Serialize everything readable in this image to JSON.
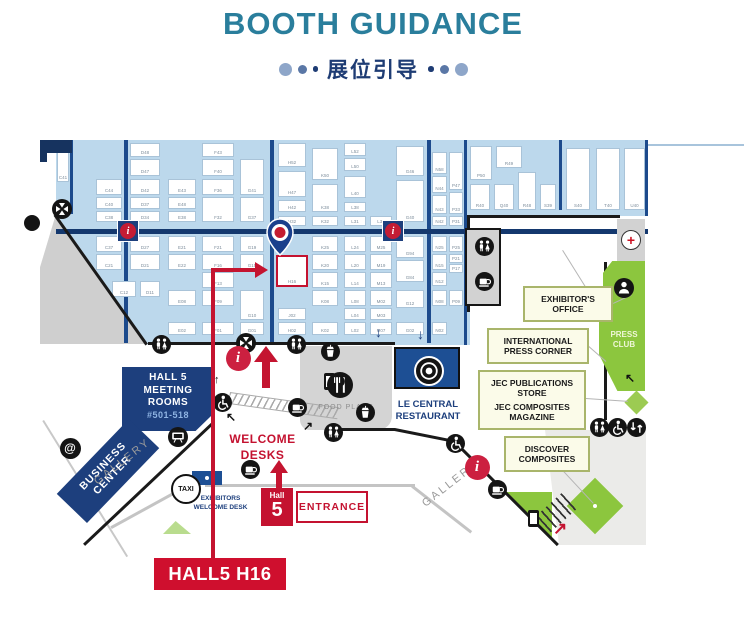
{
  "header": {
    "title": "BOOTH GUIDANCE",
    "subtitle": "展位引导"
  },
  "colors": {
    "accent_red": "#c41230",
    "navy": "#1d3f7d",
    "hall_blue": "#bcd8ec",
    "teal_title": "#2a7e9c",
    "green": "#8cc63e"
  },
  "map": {
    "labels": {
      "meeting": {
        "line1": "HALL 5",
        "line2": "MEETING",
        "line3": "ROOMS",
        "line4": "#501-518"
      },
      "business": {
        "line1": "BUSINESS",
        "line2": "CENTER"
      },
      "gallery_left": "GALLERY",
      "gallery_right": "GALLERY",
      "taxi": "TAXI",
      "exhibitors_desk": {
        "line1": "EXHIBITORS",
        "line2": "WELCOME DESK"
      },
      "welcome_desks": {
        "line1": "WELCOME",
        "line2": "DESKS"
      },
      "entrance": {
        "hall": "Hall",
        "number": "5",
        "label": "ENTRANCE"
      },
      "food_place": "FOOD PLACE",
      "le_central": {
        "line1": "LE CENTRAL",
        "line2": "RESTAURANT"
      },
      "exhibitors_office": {
        "line1": "EXHIBITOR'S",
        "line2": "OFFICE"
      },
      "intl_press": {
        "line1": "INTERNATIONAL",
        "line2": "PRESS CORNER"
      },
      "jec_store": {
        "line1": "JEC PUBLICATIONS",
        "line2": "STORE"
      },
      "jec_magazine": {
        "line1": "JEC COMPOSITES",
        "line2": "MAGAZINE"
      },
      "discover": {
        "line1": "DISCOVER",
        "line2": "COMPOSITES"
      },
      "press_club": {
        "line1": "PRESS",
        "line2": "CLUB"
      },
      "target": "HALL5 H16",
      "target_booth": "H16"
    },
    "booths": [
      [
        57,
        152,
        12,
        30,
        "C41"
      ],
      [
        96,
        179,
        26,
        16,
        "C44"
      ],
      [
        96,
        197,
        26,
        12,
        "C40"
      ],
      [
        96,
        211,
        26,
        11,
        "C38"
      ],
      [
        130,
        143,
        30,
        14,
        "D48"
      ],
      [
        130,
        159,
        30,
        17,
        "D47"
      ],
      [
        130,
        179,
        30,
        16,
        "D42"
      ],
      [
        130,
        197,
        30,
        12,
        "D37"
      ],
      [
        130,
        211,
        30,
        11,
        "D34"
      ],
      [
        168,
        179,
        28,
        16,
        "E43"
      ],
      [
        168,
        197,
        28,
        12,
        "E48"
      ],
      [
        168,
        211,
        28,
        11,
        "E38"
      ],
      [
        202,
        143,
        32,
        14,
        "F43"
      ],
      [
        202,
        159,
        32,
        17,
        "F40"
      ],
      [
        202,
        179,
        32,
        16,
        "F36"
      ],
      [
        202,
        197,
        32,
        25,
        "F32"
      ],
      [
        240,
        159,
        24,
        36,
        "G41"
      ],
      [
        240,
        197,
        24,
        25,
        "G37"
      ],
      [
        278,
        143,
        28,
        24,
        "H52"
      ],
      [
        278,
        171,
        28,
        26,
        "H47"
      ],
      [
        278,
        200,
        28,
        12,
        "H42"
      ],
      [
        278,
        216,
        28,
        10,
        "H32"
      ],
      [
        312,
        148,
        26,
        32,
        "K50"
      ],
      [
        312,
        184,
        26,
        28,
        "K38"
      ],
      [
        312,
        216,
        26,
        10,
        "K32"
      ],
      [
        344,
        143,
        22,
        13,
        "L52"
      ],
      [
        344,
        158,
        22,
        13,
        "L50"
      ],
      [
        344,
        176,
        22,
        22,
        "L40"
      ],
      [
        344,
        202,
        22,
        10,
        "L38"
      ],
      [
        344,
        216,
        22,
        10,
        "L31"
      ],
      [
        370,
        216,
        22,
        10,
        "L32"
      ],
      [
        396,
        146,
        28,
        30,
        "G46"
      ],
      [
        396,
        180,
        28,
        42,
        "G40"
      ],
      [
        432,
        152,
        15,
        22,
        "N58"
      ],
      [
        432,
        176,
        15,
        17,
        "N44"
      ],
      [
        432,
        195,
        15,
        19,
        "N43"
      ],
      [
        432,
        216,
        15,
        10,
        "N42"
      ],
      [
        449,
        152,
        14,
        38,
        "P47"
      ],
      [
        449,
        192,
        14,
        22,
        "P33"
      ],
      [
        449,
        216,
        14,
        10,
        "P31"
      ],
      [
        470,
        146,
        22,
        34,
        "P50"
      ],
      [
        496,
        146,
        26,
        22,
        "R49"
      ],
      [
        470,
        184,
        20,
        26,
        "R40"
      ],
      [
        494,
        184,
        20,
        26,
        "Q40"
      ],
      [
        518,
        172,
        18,
        38,
        "R48"
      ],
      [
        540,
        184,
        16,
        26,
        "S39"
      ],
      [
        566,
        148,
        24,
        62,
        "S40"
      ],
      [
        596,
        148,
        24,
        62,
        "T40"
      ],
      [
        624,
        148,
        21,
        62,
        "U40"
      ],
      [
        96,
        236,
        26,
        16,
        "C37"
      ],
      [
        96,
        254,
        26,
        16,
        "C21"
      ],
      [
        112,
        281,
        24,
        16,
        "C12"
      ],
      [
        130,
        236,
        30,
        16,
        "D27"
      ],
      [
        130,
        254,
        30,
        16,
        "D21"
      ],
      [
        140,
        281,
        20,
        16,
        "D11"
      ],
      [
        168,
        236,
        28,
        16,
        "E21"
      ],
      [
        168,
        254,
        28,
        16,
        "E22"
      ],
      [
        168,
        290,
        28,
        16,
        "E08"
      ],
      [
        168,
        322,
        28,
        13,
        "E02"
      ],
      [
        202,
        236,
        32,
        16,
        "F21"
      ],
      [
        202,
        254,
        32,
        16,
        "F16"
      ],
      [
        202,
        272,
        32,
        16,
        "F13"
      ],
      [
        202,
        290,
        32,
        16,
        "F09"
      ],
      [
        202,
        322,
        32,
        13,
        "F01"
      ],
      [
        240,
        236,
        24,
        16,
        "G19"
      ],
      [
        240,
        254,
        24,
        16,
        "G15"
      ],
      [
        240,
        290,
        24,
        30,
        "G10"
      ],
      [
        240,
        322,
        24,
        13,
        "G01"
      ],
      [
        278,
        308,
        28,
        12,
        "J02"
      ],
      [
        278,
        322,
        28,
        13,
        "H02"
      ],
      [
        312,
        236,
        26,
        16,
        "K25"
      ],
      [
        312,
        254,
        26,
        16,
        "K20"
      ],
      [
        312,
        272,
        26,
        16,
        "K15"
      ],
      [
        312,
        290,
        26,
        16,
        "K08"
      ],
      [
        312,
        322,
        26,
        13,
        "K02"
      ],
      [
        344,
        236,
        22,
        16,
        "L24"
      ],
      [
        344,
        254,
        22,
        16,
        "L20"
      ],
      [
        344,
        272,
        22,
        16,
        "L14"
      ],
      [
        344,
        290,
        22,
        16,
        "L08"
      ],
      [
        344,
        308,
        22,
        12,
        "L04"
      ],
      [
        344,
        322,
        22,
        13,
        "L02"
      ],
      [
        370,
        236,
        22,
        16,
        "M25"
      ],
      [
        370,
        254,
        22,
        16,
        "M19"
      ],
      [
        370,
        272,
        22,
        16,
        "M13"
      ],
      [
        370,
        290,
        22,
        16,
        "M02"
      ],
      [
        370,
        308,
        22,
        12,
        "M03"
      ],
      [
        370,
        322,
        22,
        13,
        "M07"
      ],
      [
        396,
        236,
        28,
        22,
        "G94"
      ],
      [
        396,
        260,
        28,
        22,
        "G84"
      ],
      [
        396,
        290,
        28,
        18,
        "G12"
      ],
      [
        396,
        322,
        28,
        13,
        "G02"
      ],
      [
        432,
        236,
        15,
        16,
        "N25"
      ],
      [
        432,
        254,
        15,
        16,
        "N15"
      ],
      [
        432,
        272,
        15,
        14,
        "N12"
      ],
      [
        432,
        290,
        15,
        16,
        "N08"
      ],
      [
        432,
        322,
        15,
        13,
        "N02"
      ],
      [
        449,
        236,
        14,
        16,
        "P25"
      ],
      [
        449,
        254,
        14,
        9,
        "P21"
      ],
      [
        449,
        264,
        14,
        9,
        "P17"
      ],
      [
        449,
        290,
        14,
        16,
        "P09"
      ]
    ],
    "icons": [
      [
        "crossing",
        62,
        209
      ],
      [
        "crossing",
        246,
        343
      ],
      [
        "toilet",
        161,
        344
      ],
      [
        "toilet",
        296,
        344
      ],
      [
        "toilet",
        484,
        246
      ],
      [
        "toilet",
        599,
        427
      ],
      [
        "toilet",
        333,
        432
      ],
      [
        "infosq",
        128,
        231
      ],
      [
        "infosq",
        393,
        231
      ],
      [
        "coffee",
        484,
        281
      ],
      [
        "coffee",
        297,
        407
      ],
      [
        "coffee",
        250,
        469
      ],
      [
        "coffee",
        497,
        489
      ],
      [
        "beverage",
        330,
        351
      ],
      [
        "beverage",
        365,
        412
      ],
      [
        "firstaid",
        631,
        240
      ],
      [
        "person",
        624,
        288
      ],
      [
        "wheelchair",
        617,
        427
      ],
      [
        "wheelchair",
        222,
        402
      ],
      [
        "wheelchair",
        455,
        443
      ],
      [
        "escalator",
        636,
        427
      ],
      [
        "info",
        238,
        358
      ],
      [
        "info",
        477,
        467
      ],
      [
        "phone",
        329,
        381
      ],
      [
        "phone",
        533,
        518
      ],
      [
        "at",
        70,
        448
      ],
      [
        "projector",
        178,
        437
      ],
      [
        "plate",
        427,
        369
      ],
      [
        "forkknife",
        340,
        385
      ],
      [
        "taxi",
        186,
        489
      ],
      [
        "edge",
        32,
        223
      ],
      [
        "arrow",
        383,
        333,
        "↓",
        "#1d3f7d",
        14
      ],
      [
        "arrow",
        425,
        335,
        "↓",
        "#1d3f7d",
        14
      ],
      [
        "arrow",
        222,
        383,
        "↑",
        "#111111",
        11
      ],
      [
        "arrow",
        234,
        419,
        "↖",
        "#111111",
        12
      ],
      [
        "arrow",
        633,
        380,
        "↖",
        "#111111",
        12
      ],
      [
        "arrow",
        311,
        428,
        "↗",
        "#111111",
        12
      ],
      [
        "arrow",
        561,
        528,
        "↗",
        "#c41230",
        17
      ]
    ]
  }
}
